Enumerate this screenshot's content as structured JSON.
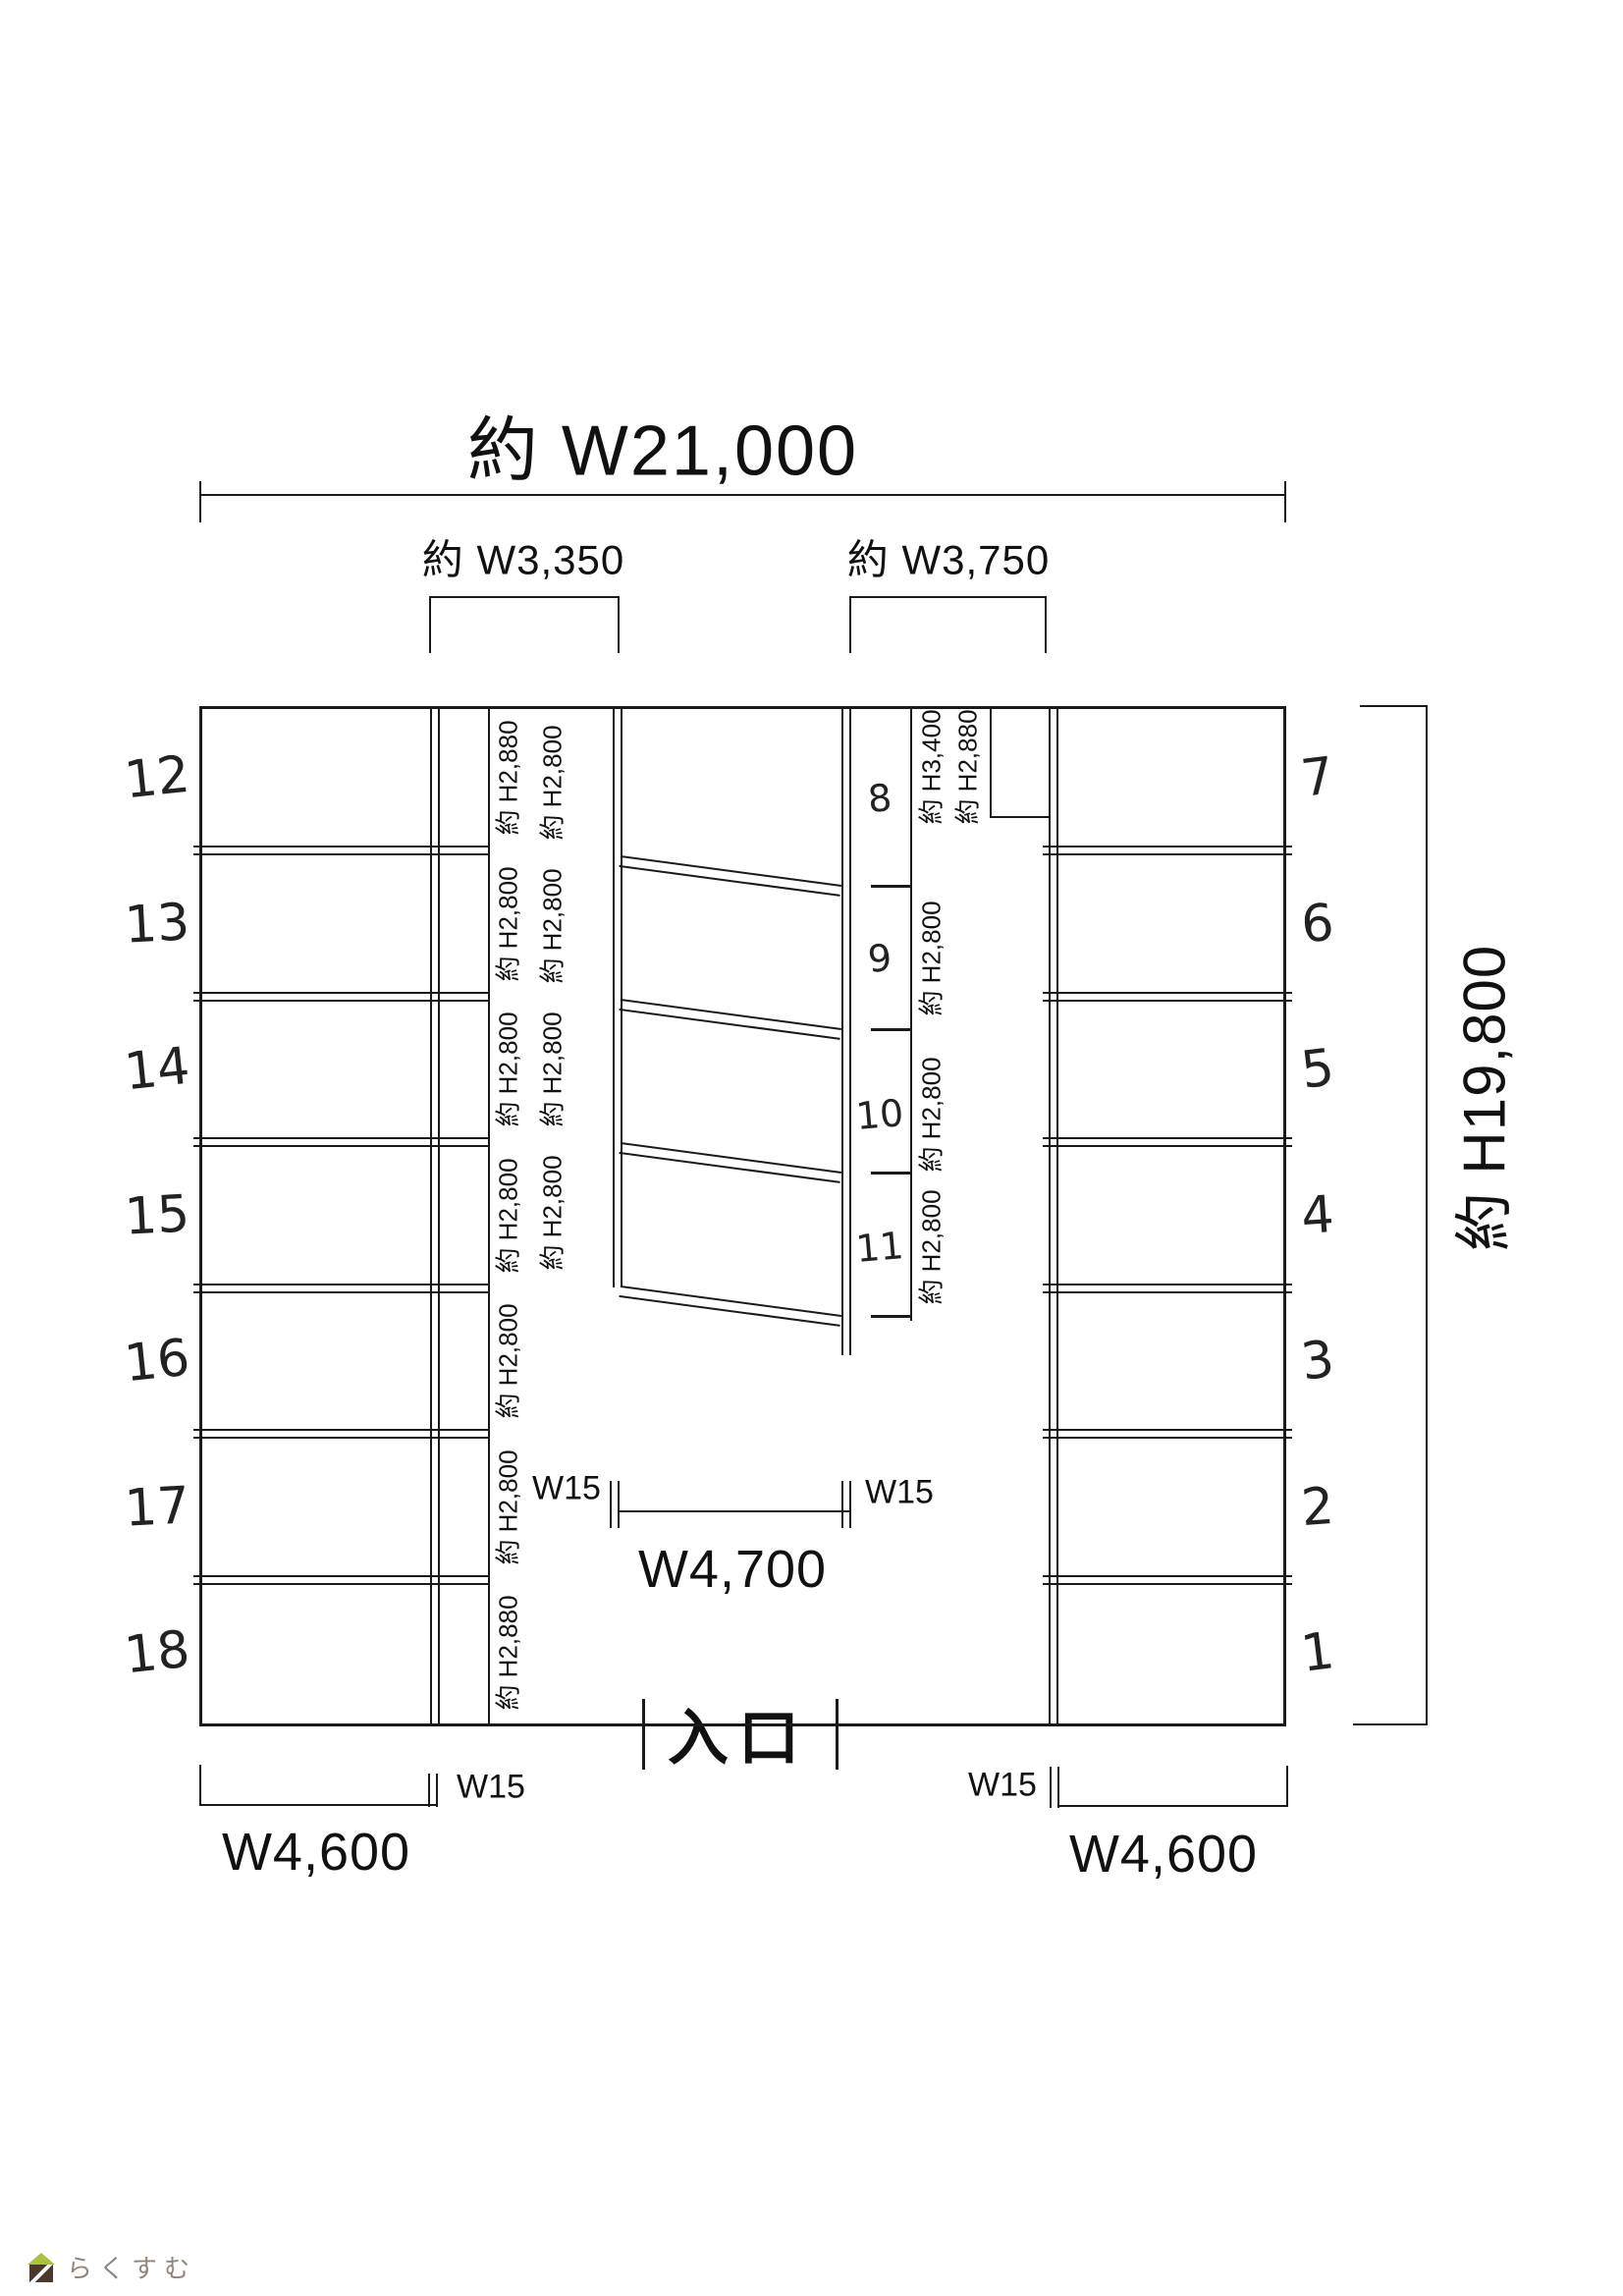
{
  "dimensions": {
    "overall_width": "約 W21,000",
    "left_bay_width": "約 W3,350",
    "right_bay_width": "約 W3,750",
    "overall_height": "約 H19,800",
    "center_opening_width": "W4,700",
    "bottom_left_width": "W4,600",
    "bottom_right_width": "W4,600",
    "wall_w15_labels": [
      "W15",
      "W15",
      "W15",
      "W15"
    ]
  },
  "entrance": {
    "label": "入口"
  },
  "left_column_spots": [
    {
      "number": "12",
      "depth": "約 H2,880"
    },
    {
      "number": "13",
      "depth": "約 H2,800"
    },
    {
      "number": "14",
      "depth": "約 H2,800"
    },
    {
      "number": "15",
      "depth": "約 H2,800"
    },
    {
      "number": "16",
      "depth": "約 H2,800"
    },
    {
      "number": "17",
      "depth": "約 H2,800"
    },
    {
      "number": "18",
      "depth": "約 H2,880"
    }
  ],
  "right_column_spots": [
    {
      "number": "7"
    },
    {
      "number": "6"
    },
    {
      "number": "5"
    },
    {
      "number": "4"
    },
    {
      "number": "3"
    },
    {
      "number": "2"
    },
    {
      "number": "1"
    }
  ],
  "middle_spots": [
    {
      "number": "8",
      "right_labels": [
        "約 H3,400",
        "約 H2,880"
      ],
      "left_label": "約 H2,800"
    },
    {
      "number": "9",
      "right_labels": [
        "約 H2,800"
      ],
      "left_label": "約 H2,800"
    },
    {
      "number": "10",
      "right_labels": [
        "約 H2,800"
      ],
      "left_label": "約 H2,800"
    },
    {
      "number": "11",
      "right_labels": [
        "約 H2,800"
      ],
      "left_label": "約 H2,800"
    }
  ],
  "logo": {
    "text": "らくすむ",
    "roof_color": "#a9c23f",
    "body_color": "#4a392c",
    "text_color": "#948579"
  },
  "colors": {
    "line": "#1a1a1a",
    "paper": "#ffffff",
    "text": "#111111"
  }
}
